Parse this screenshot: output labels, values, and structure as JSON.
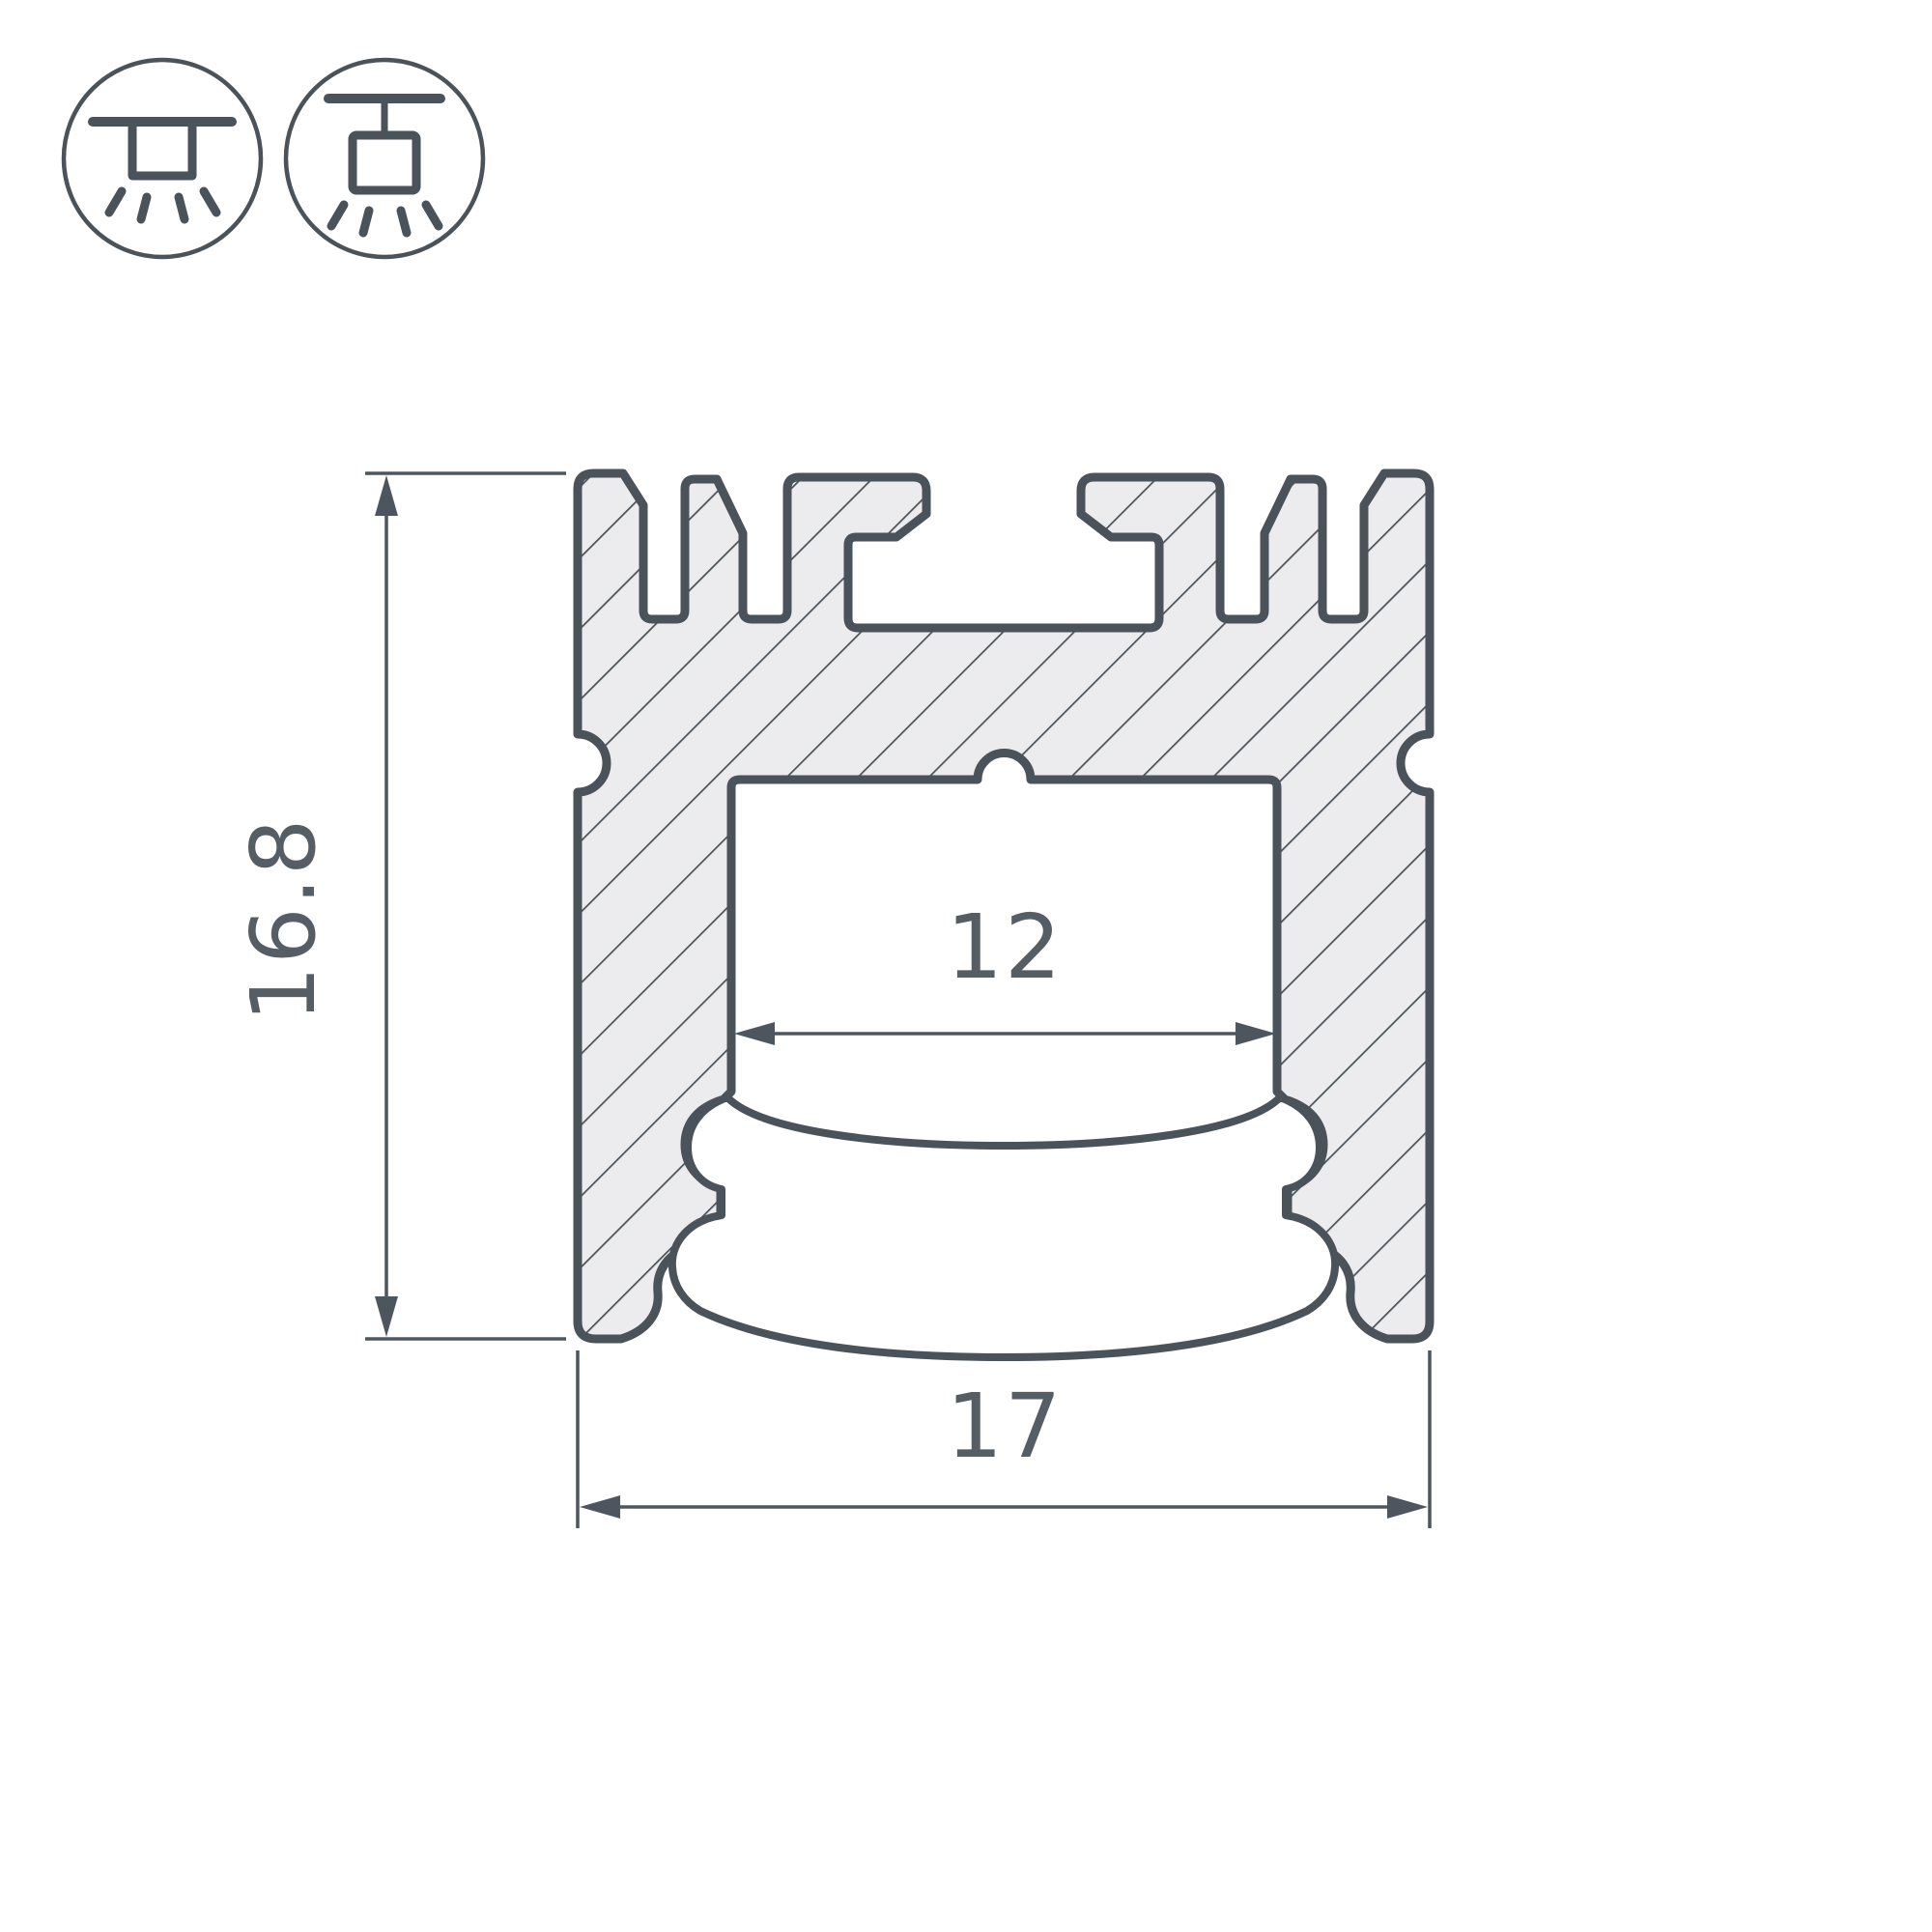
{
  "drawing": {
    "type": "technical-cross-section",
    "subject": "LED aluminum profile with diffuser, sectional view",
    "dimensions": {
      "height_label": "16.8",
      "inner_width_label": "12",
      "outer_width_label": "17"
    },
    "mount_icons": [
      {
        "name": "surface-mount-icon",
        "meaning": "surface / ceiling mount luminaire"
      },
      {
        "name": "pendant-mount-icon",
        "meaning": "suspended / pendant mount luminaire"
      }
    ],
    "colors": {
      "outline": "#4a525a",
      "body_fill": "#ececee",
      "hatch_line": "#4a525a",
      "dimension_line": "#4d565e",
      "text": "#565e65",
      "background": "#ffffff"
    }
  }
}
